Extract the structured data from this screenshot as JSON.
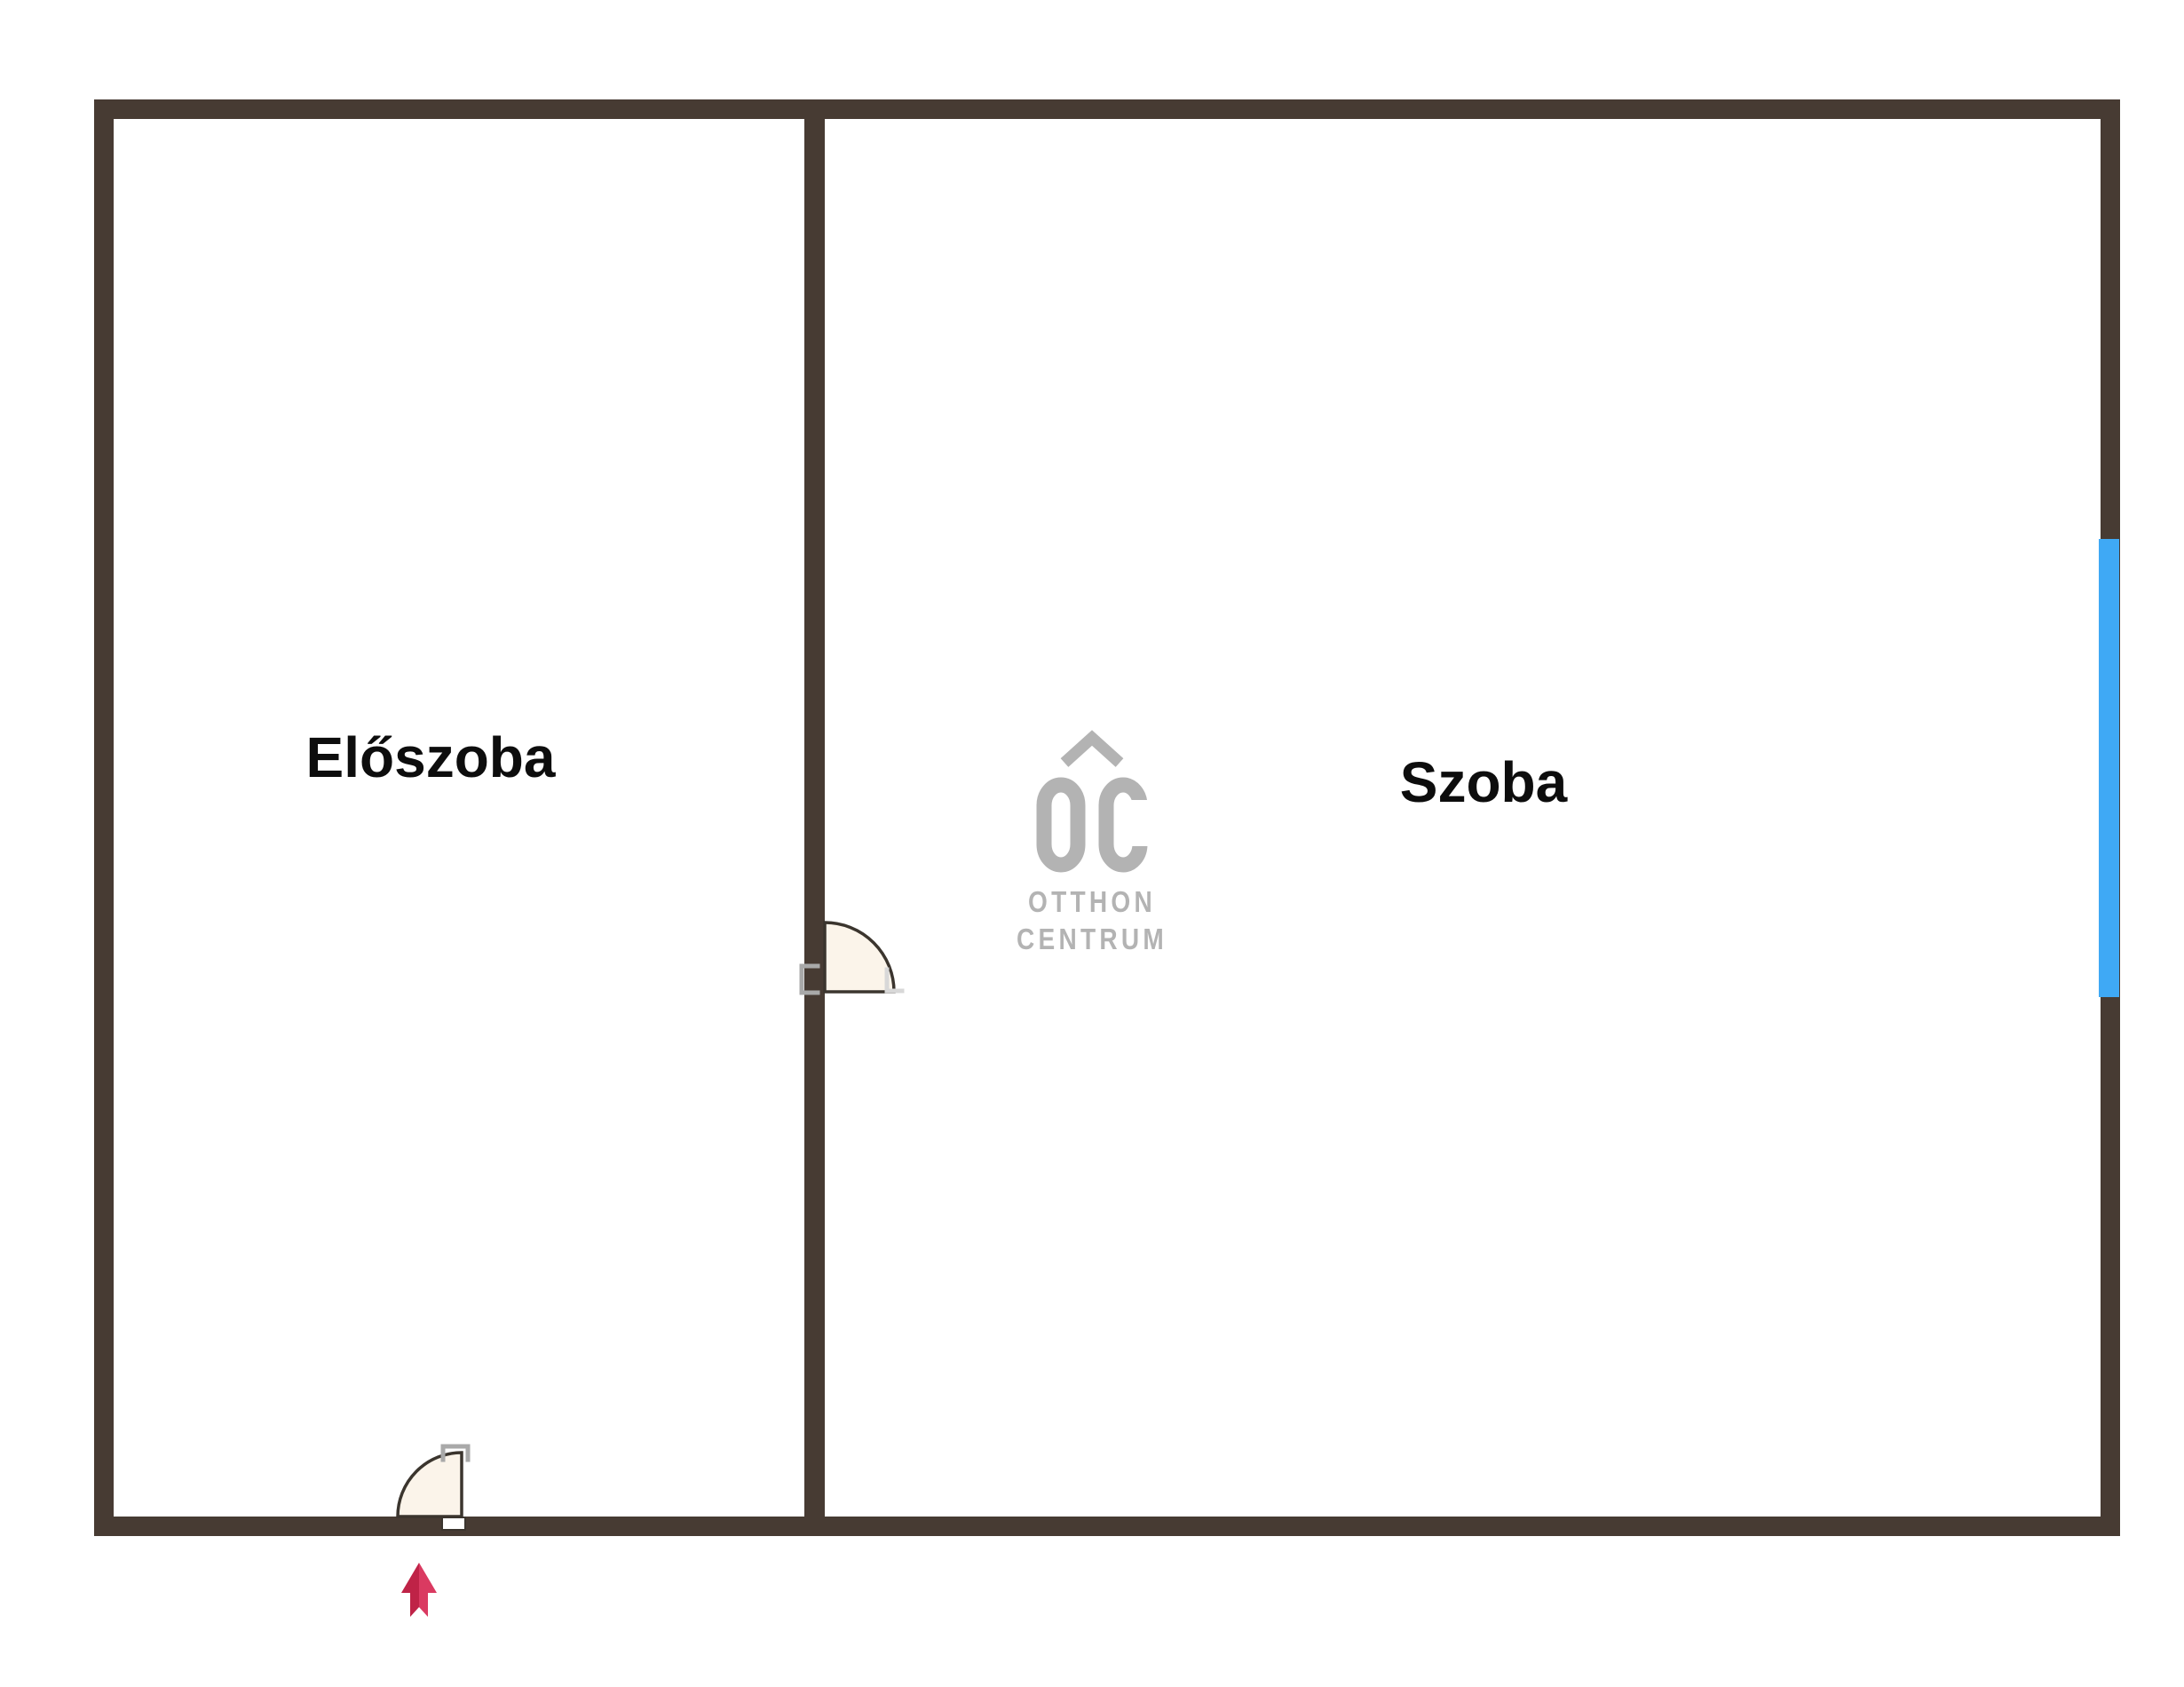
{
  "floorplan": {
    "rooms": [
      {
        "label": "Előszoba"
      },
      {
        "label": "Szoba"
      }
    ],
    "watermark": {
      "abbr": "OC",
      "line1": "OTTHON",
      "line2": "CENTRUM"
    },
    "elements": {
      "interior_door": {
        "name": "door-swing",
        "between": [
          "Előszoba",
          "Szoba"
        ]
      },
      "entrance_door": {
        "name": "door-swing",
        "room": "Előszoba",
        "wall": "bottom"
      },
      "window": {
        "name": "window",
        "wall": "right",
        "room": "Szoba"
      },
      "entrance_arrow": {
        "name": "entrance-arrow",
        "direction": "up"
      }
    },
    "colors": {
      "wall": "#473b33",
      "window": "#3fa9f5",
      "door_fill": "#fbf4ea",
      "door_stroke": "#3b352e",
      "arrow_dark": "#bf2347",
      "arrow_light": "#da3a61",
      "watermark": "#b3b3b3",
      "label_text": "#0d0d0d",
      "background": "#ffffff"
    }
  }
}
